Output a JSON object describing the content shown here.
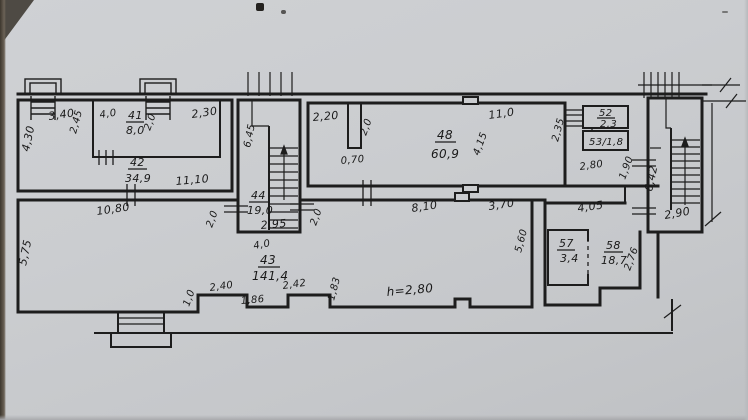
{
  "rooms": {
    "r41": {
      "no": "41",
      "area": "8,0"
    },
    "r42": {
      "no": "42",
      "area": "34,9"
    },
    "r43": {
      "no": "43",
      "area": "141,4"
    },
    "r44": {
      "no": "44",
      "area": "19,0"
    },
    "r48": {
      "no": "48",
      "area": "60,9"
    },
    "r52": {
      "no": "52",
      "area": "2,3"
    },
    "r53": {
      "label": "53/1,8"
    },
    "r57": {
      "no": "57",
      "area": "3,4"
    },
    "r58": {
      "no": "58",
      "area": "18,7"
    }
  },
  "dims": {
    "d340": "3,40",
    "d245": "2,45",
    "d430": "4,30",
    "d40a": "4,0",
    "d20a": "2,0",
    "d230": "2,30",
    "d1110": "11,10",
    "d645": "6,45",
    "d295": "2,95",
    "d20l": "2,0",
    "d20r": "2,0",
    "d220": "2,20",
    "d20b": "2,0",
    "d070": "0,70",
    "d110": "11,0",
    "d415": "4,15",
    "d235": "2,35",
    "d280": "2,80",
    "d190": "1,90",
    "d642": "6,42",
    "d290": "2,90",
    "d1080": "10,80",
    "d575": "5,75",
    "d40b": "4,0",
    "d10": "1,0",
    "d240": "2,40",
    "d186": "1,86",
    "d242": "2,42",
    "d183": "1,83",
    "h280": "h=2,80",
    "d810": "8,10",
    "d370": "3,70",
    "d560": "5,60",
    "d405": "4,05",
    "d276": "2,76"
  }
}
